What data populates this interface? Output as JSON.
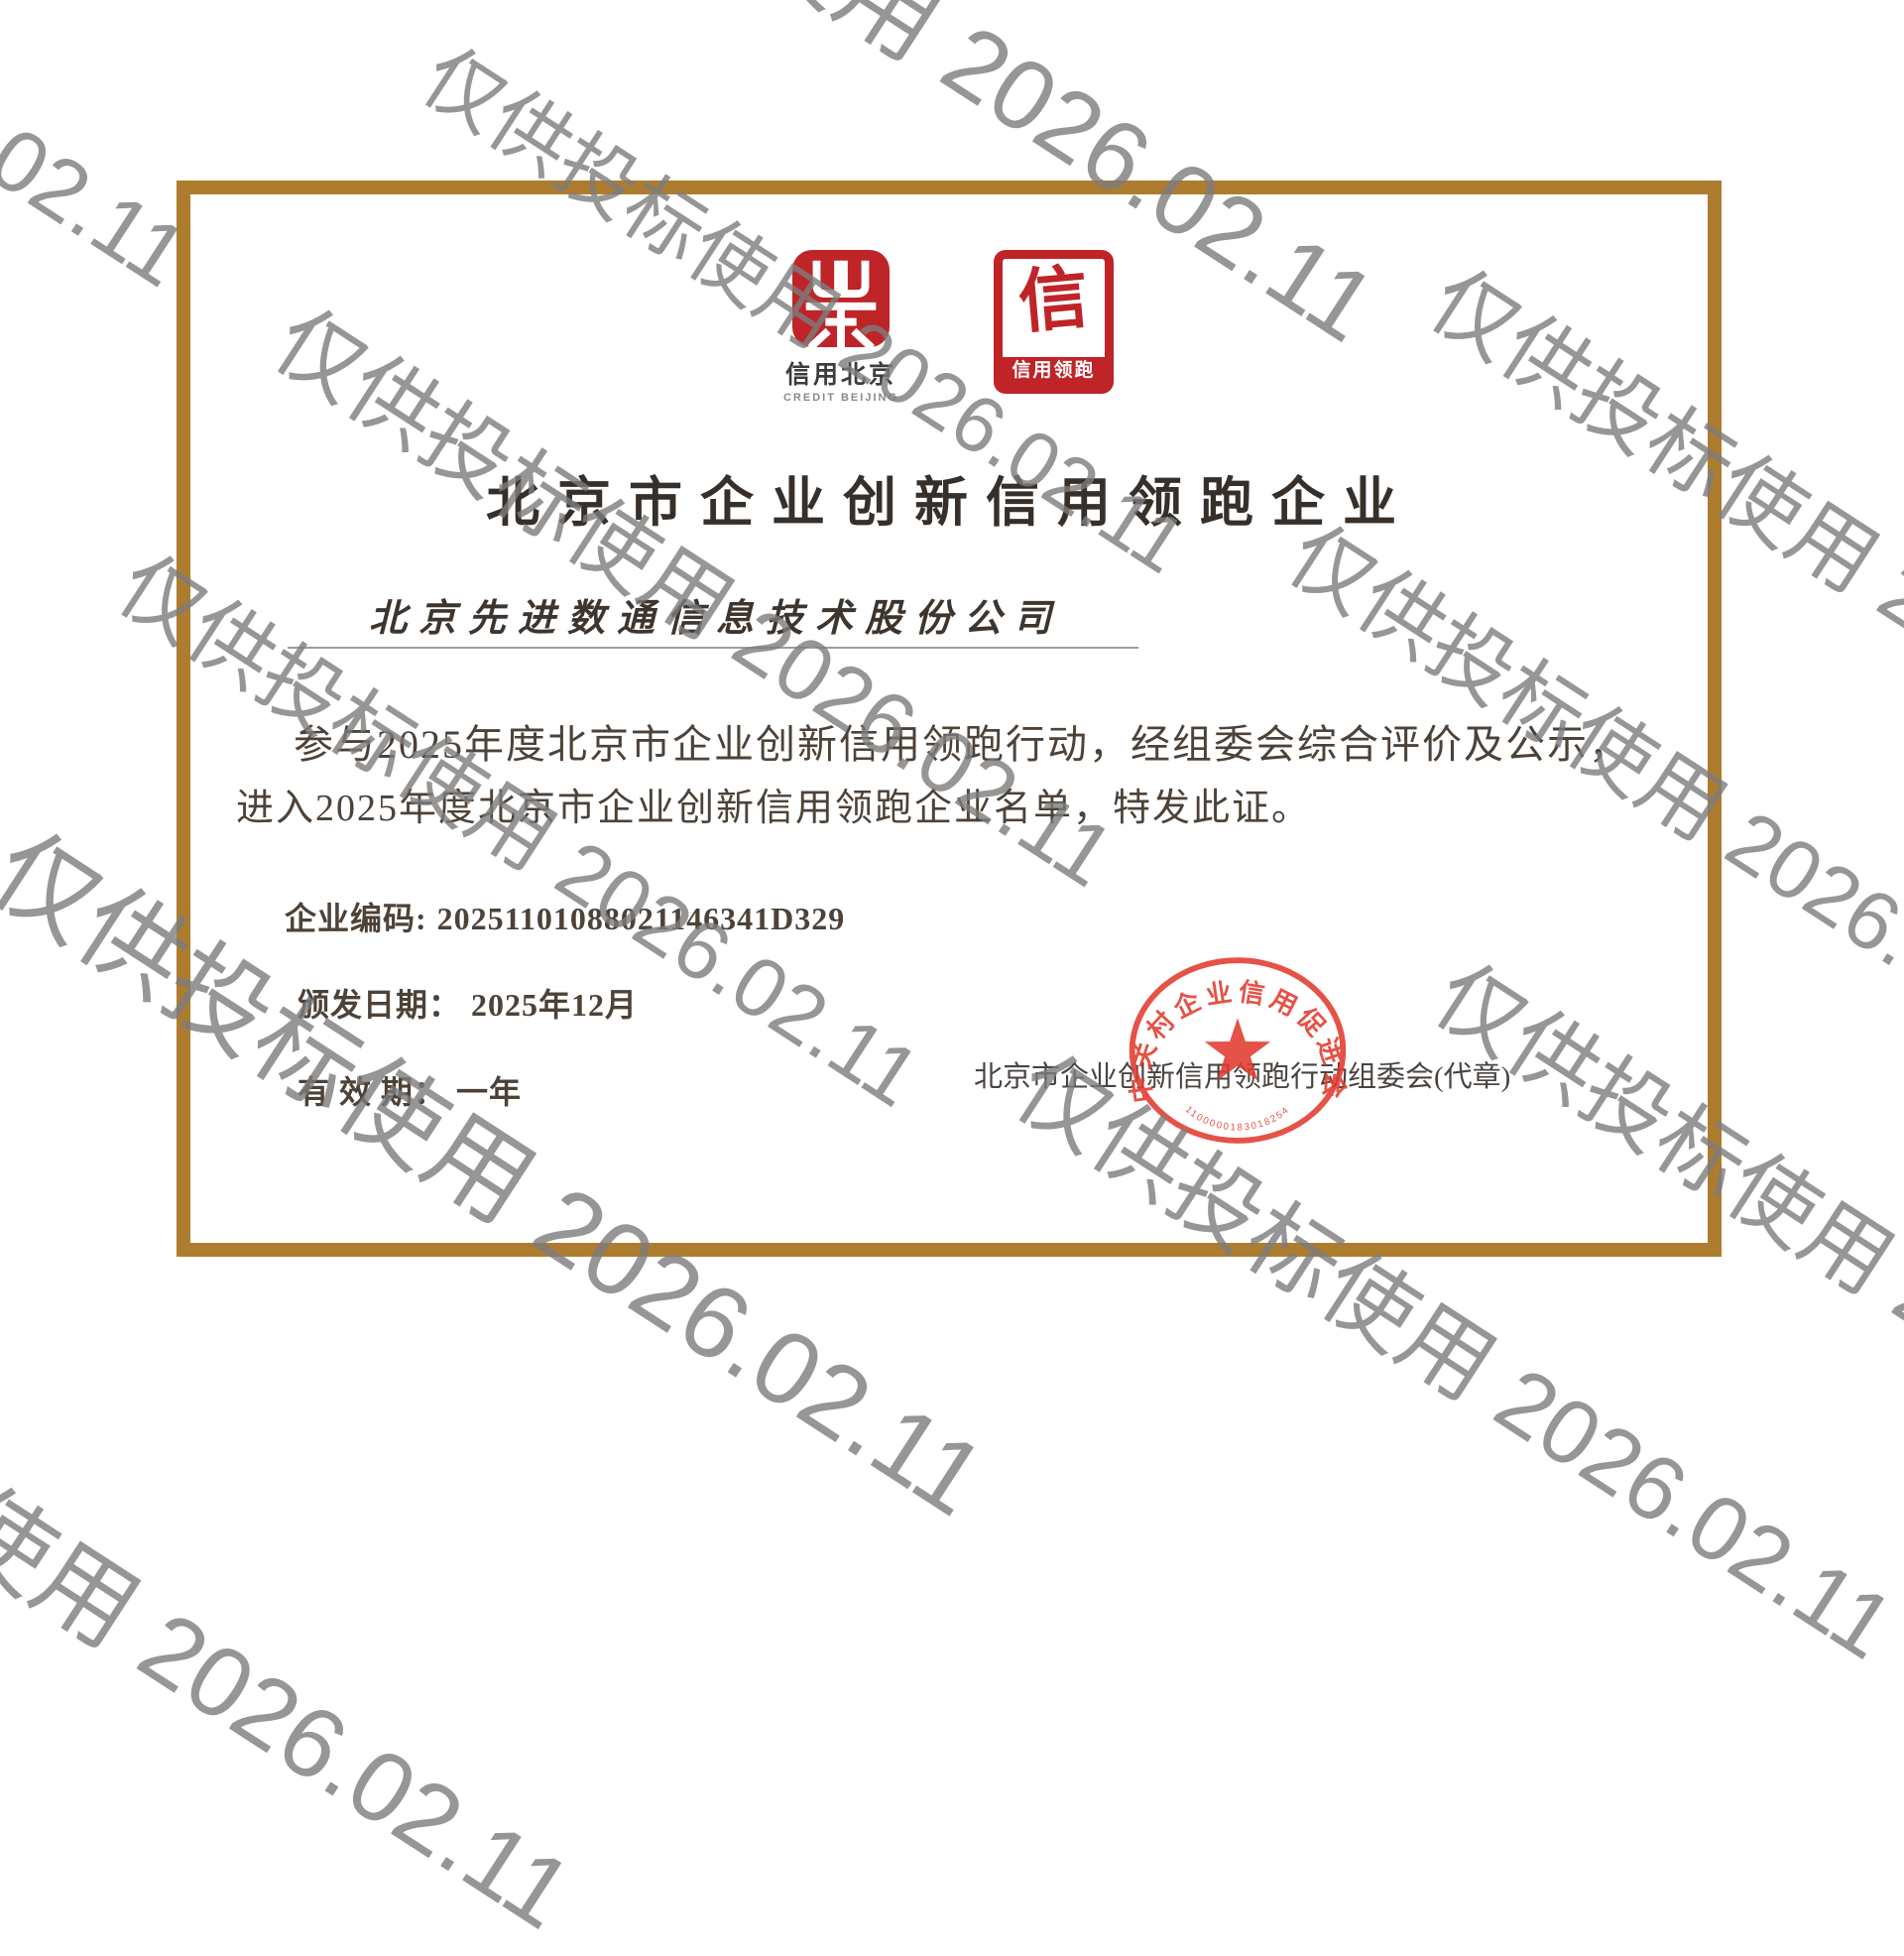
{
  "watermark": {
    "text": "仅供投标使用 2026.02.11",
    "color_gray": "#7d7d7d"
  },
  "certificate": {
    "logo_credit_beijing": {
      "name_cn": "信用北京",
      "name_en": "CREDIT BEIJING"
    },
    "logo_credit_leader": {
      "glyph": "信",
      "label": "信用领跑"
    },
    "title": "北京市企业创新信用领跑企业",
    "company_name": "北京先进数通信息技术股份公司",
    "body_line1": "参与2025年度北京市企业创新信用领跑行动，经组委会综合评价及公示，",
    "body_line2": "进入2025年度北京市企业创新信用领跑企业名单，特发此证。",
    "fields": {
      "code_label": "企业编码:",
      "code_value": "20251101088021146341D329",
      "issue_label": "颁发日期：",
      "issue_value": "2025年12月",
      "validity_label": "有 效 期：",
      "validity_value": "一年"
    },
    "issuer": "北京市企业创新信用领跑行动组委会(代章)",
    "seal": {
      "ring_text": "中关村企业信用促进会",
      "serial": "1100000183018254"
    },
    "colors": {
      "frame": "#ae7c2e",
      "logo_red": "#bf2428",
      "seal_red": "#e23b2e",
      "watermark_gray": "#7d7d7d",
      "title_ink": "#37302a",
      "body_ink": "#4d4238"
    }
  }
}
